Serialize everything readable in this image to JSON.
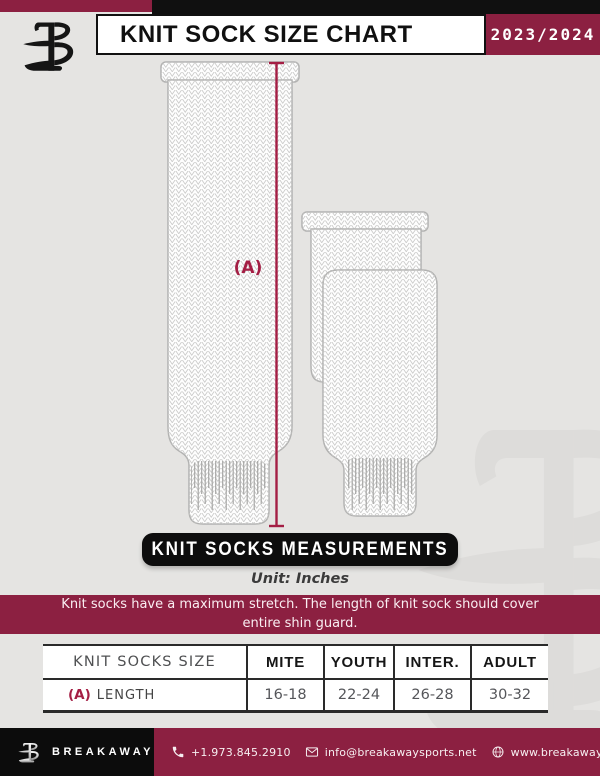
{
  "header": {
    "title": "KNIT SOCK SIZE CHART",
    "season": "2023/2024"
  },
  "diagram": {
    "measure_label": "(A)",
    "banner_title": "KNIT SOCKS MEASUREMENTS",
    "unit_note": "Unit: Inches",
    "notice_line1": "Knit socks have a maximum stretch. The length of knit sock should cover",
    "notice_line2": "entire shin guard."
  },
  "table": {
    "columns": [
      "KNIT SOCKS SIZE",
      "MITE",
      "YOUTH",
      "INTER.",
      "ADULT"
    ],
    "rows": [
      {
        "key": "(A)",
        "label": "LENGTH",
        "values": [
          "16-18",
          "22-24",
          "26-28",
          "30-32"
        ]
      }
    ]
  },
  "footer": {
    "brand": "BREAKAWAY",
    "phone": "+1.973.845.2910",
    "email": "info@breakawaysports.net",
    "website": "www.breakawaysports.net"
  },
  "colors": {
    "maroon": "#8c2041",
    "accent_red": "#a41e44",
    "black": "#101010",
    "background": "#e5e4e2"
  }
}
